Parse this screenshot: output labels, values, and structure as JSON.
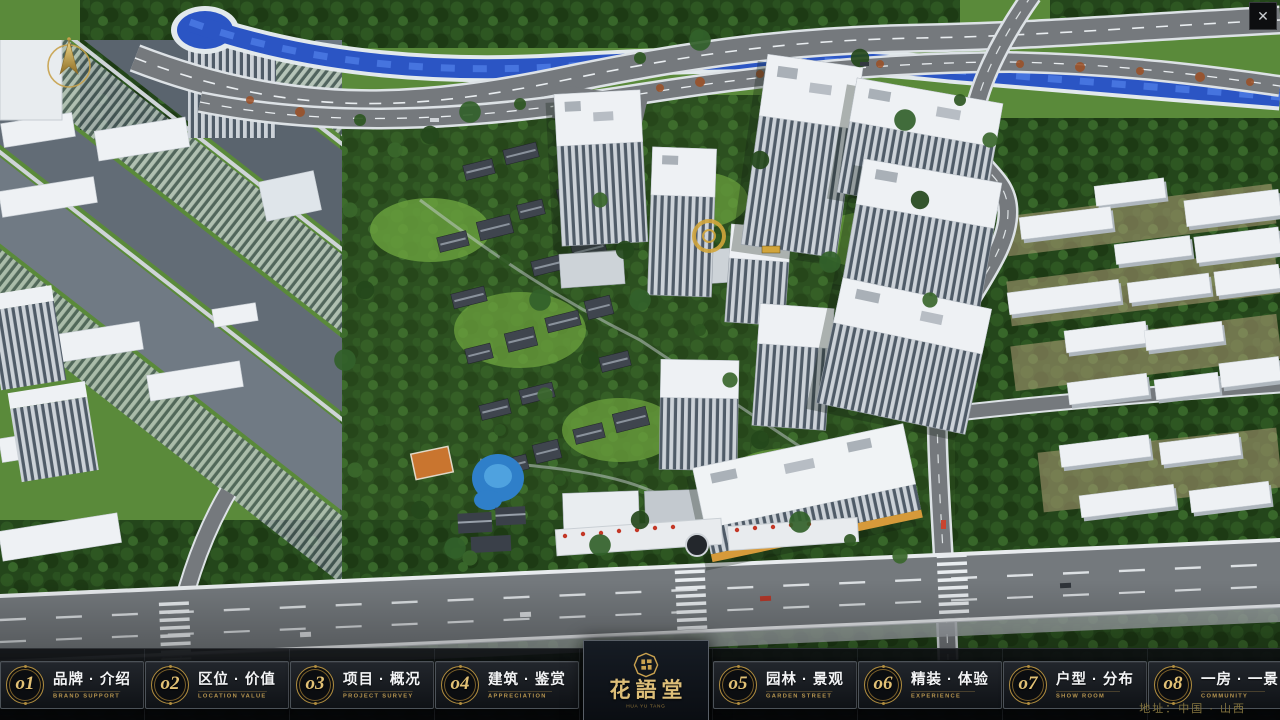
{
  "window": {
    "close_glyph": "✕"
  },
  "brand": {
    "logo_name": "花語堂",
    "logo_subtitle": "HUA YU TANG",
    "address": "地址：中国 · 山西"
  },
  "nav": {
    "items": [
      {
        "num": "o1",
        "label": "品牌 · 介绍",
        "sub": "BRAND SUPPORT"
      },
      {
        "num": "o2",
        "label": "区位 · 价值",
        "sub": "LOCATION VALUE"
      },
      {
        "num": "o3",
        "label": "项目 · 概况",
        "sub": "PROJECT SURVEY"
      },
      {
        "num": "o4",
        "label": "建筑 · 鉴赏",
        "sub": "APPRECIATION"
      },
      {
        "num": "o5",
        "label": "园林 · 景观",
        "sub": "GARDEN STREET"
      },
      {
        "num": "o6",
        "label": "精装 · 体验",
        "sub": "EXPERIENCE"
      },
      {
        "num": "o7",
        "label": "户型 · 分布",
        "sub": "SHOW ROOM"
      },
      {
        "num": "o8",
        "label": "一房 · 一景",
        "sub": "COMMUNITY"
      }
    ]
  },
  "colors": {
    "gold": "#c9a24b",
    "bar_bg": "#0a0c0f",
    "river_blue": "#2b55c4"
  }
}
